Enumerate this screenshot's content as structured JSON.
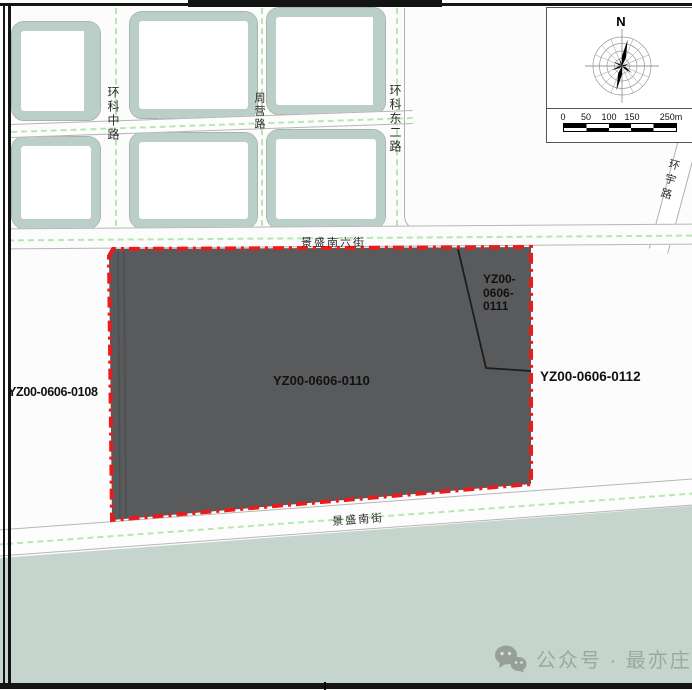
{
  "roads": {
    "huanke_zhong": "环科中路",
    "zhouying": "周营路",
    "huanke_dong_er": "环科东二路",
    "huanyu": "环宇路",
    "jingsheng_nan_liu": "景盛南六街",
    "jingsheng_nan": "景盛南街"
  },
  "parcels": {
    "west": "YZ00-0606-0108",
    "main": "YZ00-0606-0110",
    "northeast_l1": "YZ00-",
    "northeast_l2": "0606-",
    "northeast_l3": "0111",
    "east": "YZ00-0606-0112"
  },
  "compass": {
    "north": "N"
  },
  "scalebar": {
    "labels": [
      "0",
      "50",
      "100",
      "150",
      "250m"
    ]
  },
  "watermark": {
    "text": "公众号 · 最亦庄"
  },
  "colors": {
    "parcel_fill": "#595a5c",
    "parcel_boundary_red": "#e81c1c",
    "block_teal": "#b9cfc7",
    "south_green": "#c5d5cd",
    "road_centerline_green": "#a5e39e"
  }
}
